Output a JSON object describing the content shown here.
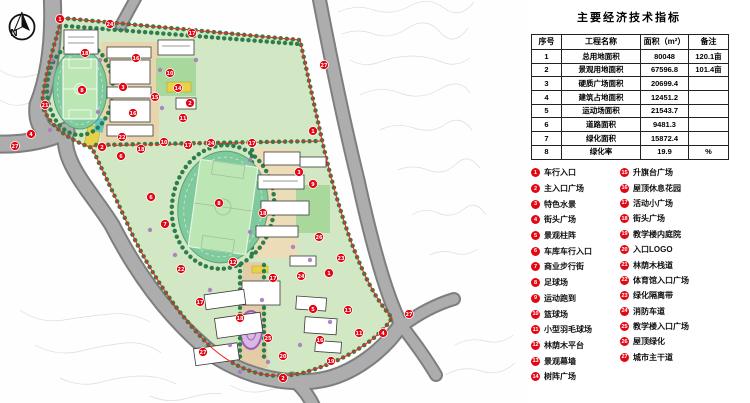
{
  "panel": {
    "title": "主要经济技术指标",
    "table": {
      "headers": [
        "序号",
        "工程名称",
        "面积（m²）",
        "备注"
      ],
      "rows": [
        [
          "1",
          "总用地面积",
          "80048",
          "120.1亩"
        ],
        [
          "2",
          "景观用地面积",
          "67596.8",
          "101.4亩"
        ],
        [
          "3",
          "硬质广场面积",
          "20699.4",
          ""
        ],
        [
          "4",
          "建筑占地面积",
          "12451.2",
          ""
        ],
        [
          "5",
          "运动场面积",
          "21543.7",
          ""
        ],
        [
          "6",
          "道路面积",
          "9481.3",
          ""
        ],
        [
          "7",
          "绿化面积",
          "15872.4",
          ""
        ],
        [
          "8",
          "绿化率",
          "19.9",
          "%"
        ]
      ]
    },
    "legend": {
      "left": [
        {
          "n": "1",
          "label": "车行入口"
        },
        {
          "n": "2",
          "label": "主入口广场"
        },
        {
          "n": "3",
          "label": "特色水景"
        },
        {
          "n": "4",
          "label": "街头广场"
        },
        {
          "n": "5",
          "label": "景观柱阵"
        },
        {
          "n": "6",
          "label": "车库车行入口"
        },
        {
          "n": "7",
          "label": "商业步行街"
        },
        {
          "n": "8",
          "label": "足球场"
        },
        {
          "n": "9",
          "label": "运动跑到"
        },
        {
          "n": "10",
          "label": "篮球场"
        },
        {
          "n": "11",
          "label": "小型羽毛球场"
        },
        {
          "n": "12",
          "label": "林荫木平台"
        },
        {
          "n": "13",
          "label": "景观幕墙"
        },
        {
          "n": "14",
          "label": "树阵广场"
        }
      ],
      "right": [
        {
          "n": "15",
          "label": "升旗台广场"
        },
        {
          "n": "16",
          "label": "屋顶休息花园"
        },
        {
          "n": "17",
          "label": "活动小广场"
        },
        {
          "n": "18",
          "label": "街头广场"
        },
        {
          "n": "19",
          "label": "教学楼内庭院"
        },
        {
          "n": "20",
          "label": "入口LOGO"
        },
        {
          "n": "21",
          "label": "林荫木栈道"
        },
        {
          "n": "22",
          "label": "体育馆入口广场"
        },
        {
          "n": "23",
          "label": "绿化隔离带"
        },
        {
          "n": "24",
          "label": "消防车道"
        },
        {
          "n": "25",
          "label": "教学楼入口广场"
        },
        {
          "n": "26",
          "label": "屋顶绿化"
        },
        {
          "n": "27",
          "label": "城市主干道"
        }
      ]
    }
  },
  "map": {
    "compass_label": "N",
    "markers": [
      {
        "n": "1",
        "x": 60,
        "y": 19
      },
      {
        "n": "24",
        "x": 110,
        "y": 24
      },
      {
        "n": "17",
        "x": 192,
        "y": 33
      },
      {
        "n": "27",
        "x": 324,
        "y": 65
      },
      {
        "n": "18",
        "x": 85,
        "y": 53
      },
      {
        "n": "16",
        "x": 136,
        "y": 58
      },
      {
        "n": "10",
        "x": 170,
        "y": 73
      },
      {
        "n": "3",
        "x": 123,
        "y": 87
      },
      {
        "n": "8",
        "x": 82,
        "y": 90
      },
      {
        "n": "14",
        "x": 178,
        "y": 88
      },
      {
        "n": "15",
        "x": 155,
        "y": 97
      },
      {
        "n": "2",
        "x": 190,
        "y": 103
      },
      {
        "n": "21",
        "x": 45,
        "y": 105
      },
      {
        "n": "16",
        "x": 133,
        "y": 113
      },
      {
        "n": "11",
        "x": 183,
        "y": 118
      },
      {
        "n": "1",
        "x": 313,
        "y": 131
      },
      {
        "n": "4",
        "x": 31,
        "y": 134
      },
      {
        "n": "22",
        "x": 122,
        "y": 137
      },
      {
        "n": "10",
        "x": 164,
        "y": 142
      },
      {
        "n": "17",
        "x": 188,
        "y": 145
      },
      {
        "n": "24",
        "x": 211,
        "y": 143
      },
      {
        "n": "17",
        "x": 252,
        "y": 143
      },
      {
        "n": "27",
        "x": 15,
        "y": 146
      },
      {
        "n": "2",
        "x": 102,
        "y": 147
      },
      {
        "n": "18",
        "x": 141,
        "y": 149
      },
      {
        "n": "6",
        "x": 121,
        "y": 156
      },
      {
        "n": "3",
        "x": 299,
        "y": 172
      },
      {
        "n": "9",
        "x": 313,
        "y": 184
      },
      {
        "n": "6",
        "x": 151,
        "y": 197
      },
      {
        "n": "8",
        "x": 219,
        "y": 203
      },
      {
        "n": "18",
        "x": 263,
        "y": 213
      },
      {
        "n": "7",
        "x": 165,
        "y": 224
      },
      {
        "n": "26",
        "x": 319,
        "y": 237
      },
      {
        "n": "23",
        "x": 341,
        "y": 258
      },
      {
        "n": "12",
        "x": 233,
        "y": 262
      },
      {
        "n": "22",
        "x": 181,
        "y": 269
      },
      {
        "n": "1",
        "x": 329,
        "y": 273
      },
      {
        "n": "24",
        "x": 301,
        "y": 276
      },
      {
        "n": "17",
        "x": 273,
        "y": 278
      },
      {
        "n": "17",
        "x": 200,
        "y": 302
      },
      {
        "n": "5",
        "x": 313,
        "y": 309
      },
      {
        "n": "13",
        "x": 348,
        "y": 310
      },
      {
        "n": "27",
        "x": 409,
        "y": 314
      },
      {
        "n": "18",
        "x": 240,
        "y": 318
      },
      {
        "n": "25",
        "x": 268,
        "y": 338
      },
      {
        "n": "16",
        "x": 320,
        "y": 340
      },
      {
        "n": "11",
        "x": 359,
        "y": 333
      },
      {
        "n": "4",
        "x": 383,
        "y": 333
      },
      {
        "n": "19",
        "x": 331,
        "y": 361
      },
      {
        "n": "20",
        "x": 283,
        "y": 356
      },
      {
        "n": "2",
        "x": 283,
        "y": 378
      },
      {
        "n": "27",
        "x": 203,
        "y": 352
      }
    ]
  },
  "colors": {
    "marker_red": "#e30613",
    "boundary_red": "#f5281c",
    "site_green": "#d2e8c4",
    "track_green": "#7fca9c",
    "field_green": "#bce7b4",
    "tree_green": "#2e7d4c",
    "road_gray": "#adadad"
  }
}
